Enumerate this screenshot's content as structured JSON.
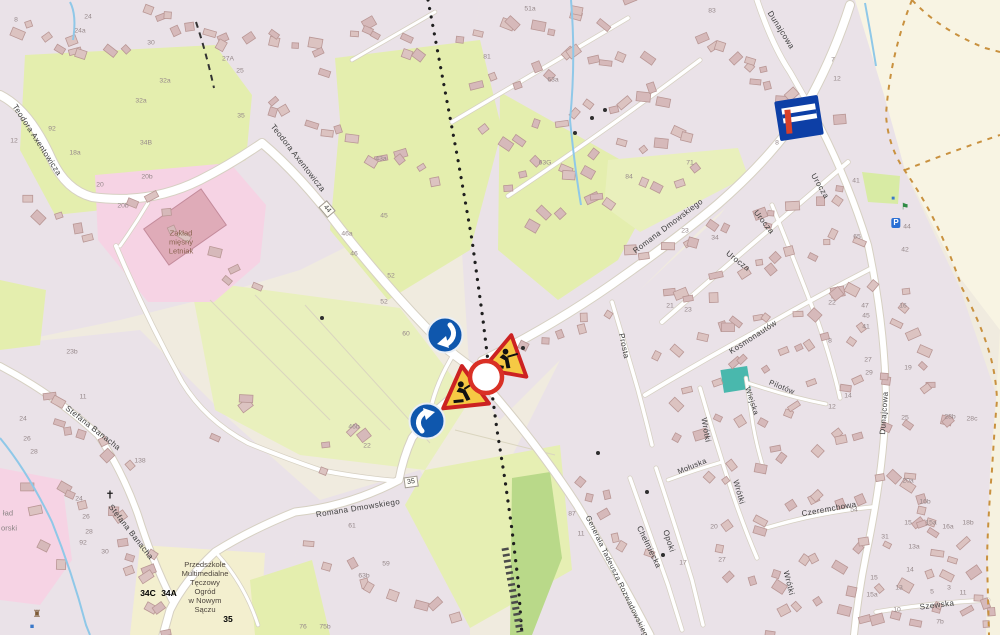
{
  "map": {
    "colors": {
      "residential": "#eae2e8",
      "field_green": "#e4eeae",
      "field_pale": "#f3efcf",
      "dark_green_band": "#b9d989",
      "commercial_pink": "#f6d3e4",
      "open_cream": "#f8f4e3",
      "road_white": "#ffffff",
      "boundary_dash_orange": "#c9913f",
      "stream_blue": "#8fc8e8",
      "sign_blue": "#0f57ad",
      "sign_red": "#d93025",
      "sign_yellow": "#f6c944",
      "flag_blue": "#0d3fa6",
      "flag_red": "#d8402a"
    },
    "streets": [
      {
        "label": "Teodora Axentowicza",
        "x": 37,
        "y": 140,
        "rot": 57
      },
      {
        "label": "Teodora Axentowicza",
        "x": 298,
        "y": 158,
        "rot": 52
      },
      {
        "label": "Romana Dmowskiego",
        "x": 668,
        "y": 226,
        "rot": -37
      },
      {
        "label": "Romana Dmowskiego",
        "x": 358,
        "y": 508,
        "rot": -9
      },
      {
        "label": "Dunajcowa",
        "x": 781,
        "y": 30,
        "rot": 58
      },
      {
        "label": "Dunajcowa",
        "x": 884,
        "y": 413,
        "rot": -86
      },
      {
        "label": "Urocza",
        "x": 820,
        "y": 186,
        "rot": 60
      },
      {
        "label": "Urocza",
        "x": 764,
        "y": 222,
        "rot": 52
      },
      {
        "label": "Urocza",
        "x": 738,
        "y": 261,
        "rot": 38
      },
      {
        "label": "Kosmonautów",
        "x": 753,
        "y": 337,
        "rot": -33
      },
      {
        "label": "Prosta",
        "x": 624,
        "y": 346,
        "rot": 78
      },
      {
        "label": "Stefana Banacha",
        "x": 93,
        "y": 428,
        "rot": 38
      },
      {
        "label": "Stefana Banacha",
        "x": 131,
        "y": 532,
        "rot": 52
      },
      {
        "label": "Generała Tadeusza Rozwadowskiego",
        "x": 618,
        "y": 578,
        "rot": 64,
        "size": 7.5
      },
      {
        "label": "Chełmiecka",
        "x": 649,
        "y": 547,
        "rot": 64
      },
      {
        "label": "Opoki",
        "x": 669,
        "y": 541,
        "rot": 72
      },
      {
        "label": "Mołuska",
        "x": 692,
        "y": 466,
        "rot": -22,
        "size": 7.5
      },
      {
        "label": "Wrótki",
        "x": 706,
        "y": 430,
        "rot": 80
      },
      {
        "label": "Wrótki",
        "x": 739,
        "y": 492,
        "rot": 74
      },
      {
        "label": "Wrótki",
        "x": 789,
        "y": 583,
        "rot": 76
      },
      {
        "label": "Wiejska",
        "x": 752,
        "y": 401,
        "rot": 72,
        "size": 7.5
      },
      {
        "label": "Pilotów",
        "x": 782,
        "y": 387,
        "rot": 22,
        "size": 7.5
      },
      {
        "label": "Czeremchowa",
        "x": 829,
        "y": 509,
        "rot": -10
      },
      {
        "label": "Szewska",
        "x": 937,
        "y": 605,
        "rot": -7
      }
    ],
    "route_badges": [
      {
        "label": "44",
        "x": 327,
        "y": 209,
        "rot": 50
      },
      {
        "label": "35",
        "x": 411,
        "y": 482,
        "rot": -8
      }
    ],
    "pois": [
      {
        "label": "Zakład\nmięsny\nLetniak",
        "x": 181,
        "y": 243,
        "color": "#8a6450"
      },
      {
        "label": "Przedszkole\nMultimedialne\nTęczowy\nOgród\nw Nowym\nSączu",
        "x": 205,
        "y": 588,
        "color": "#4e463e"
      },
      {
        "label": "ład",
        "x": 8,
        "y": 514,
        "color": "#8a8384"
      },
      {
        "label": "orski",
        "x": 9,
        "y": 529,
        "color": "#8a8384"
      }
    ],
    "annotations": [
      {
        "label": "34C",
        "x": 148,
        "y": 593
      },
      {
        "label": "34A",
        "x": 169,
        "y": 593
      },
      {
        "label": "35",
        "x": 228,
        "y": 619
      }
    ],
    "icons": [
      {
        "name": "cross-icon",
        "glyph": "✝",
        "x": 110,
        "y": 496,
        "color": "#1a1a1a",
        "size": 11
      },
      {
        "name": "parking-icon",
        "glyph": "P",
        "x": 896,
        "y": 223,
        "color": "#ffffff",
        "bg": "#2a6fd4",
        "size": 8
      },
      {
        "name": "playground-icon",
        "glyph": "⚑",
        "x": 905,
        "y": 207,
        "color": "#2e8b44",
        "size": 9
      },
      {
        "name": "info-icon",
        "glyph": "■",
        "x": 893,
        "y": 199,
        "color": "#3a78c9",
        "size": 6
      },
      {
        "name": "monument-icon",
        "glyph": "♜",
        "x": 37,
        "y": 615,
        "color": "#7d5a36",
        "size": 10
      },
      {
        "name": "water-icon",
        "glyph": "■",
        "x": 32,
        "y": 627,
        "color": "#3a78c9",
        "size": 7
      }
    ],
    "house_numbers": [
      {
        "label": "8",
        "x": 16,
        "y": 20
      },
      {
        "label": "24",
        "x": 88,
        "y": 17
      },
      {
        "label": "24a",
        "x": 80,
        "y": 31
      },
      {
        "label": "30",
        "x": 151,
        "y": 43
      },
      {
        "label": "32a",
        "x": 165,
        "y": 81
      },
      {
        "label": "32a",
        "x": 141,
        "y": 101
      },
      {
        "label": "92",
        "x": 52,
        "y": 129
      },
      {
        "label": "34B",
        "x": 146,
        "y": 143
      },
      {
        "label": "20b",
        "x": 147,
        "y": 177
      },
      {
        "label": "20b",
        "x": 123,
        "y": 206
      },
      {
        "label": "27A",
        "x": 228,
        "y": 59
      },
      {
        "label": "25",
        "x": 240,
        "y": 71
      },
      {
        "label": "12",
        "x": 14,
        "y": 141
      },
      {
        "label": "18a",
        "x": 75,
        "y": 153
      },
      {
        "label": "20",
        "x": 100,
        "y": 185
      },
      {
        "label": "35",
        "x": 241,
        "y": 116
      },
      {
        "label": "23b",
        "x": 72,
        "y": 352
      },
      {
        "label": "51a",
        "x": 530,
        "y": 9
      },
      {
        "label": "83",
        "x": 712,
        "y": 11
      },
      {
        "label": "63G",
        "x": 545,
        "y": 163
      },
      {
        "label": "43a",
        "x": 381,
        "y": 159
      },
      {
        "label": "81",
        "x": 487,
        "y": 57
      },
      {
        "label": "63a",
        "x": 553,
        "y": 80
      },
      {
        "label": "71",
        "x": 690,
        "y": 163
      },
      {
        "label": "84",
        "x": 629,
        "y": 177
      },
      {
        "label": "41",
        "x": 856,
        "y": 181
      },
      {
        "label": "65",
        "x": 857,
        "y": 237
      },
      {
        "label": "34",
        "x": 715,
        "y": 238
      },
      {
        "label": "23",
        "x": 685,
        "y": 231
      },
      {
        "label": "21",
        "x": 670,
        "y": 306
      },
      {
        "label": "23",
        "x": 688,
        "y": 310
      },
      {
        "label": "7",
        "x": 833,
        "y": 60
      },
      {
        "label": "12",
        "x": 837,
        "y": 79
      },
      {
        "label": "8",
        "x": 777,
        "y": 143
      },
      {
        "label": "46a",
        "x": 347,
        "y": 234
      },
      {
        "label": "46",
        "x": 354,
        "y": 254
      },
      {
        "label": "52",
        "x": 391,
        "y": 276
      },
      {
        "label": "52",
        "x": 384,
        "y": 302
      },
      {
        "label": "60",
        "x": 406,
        "y": 334
      },
      {
        "label": "45",
        "x": 384,
        "y": 216
      },
      {
        "label": "16",
        "x": 903,
        "y": 306
      },
      {
        "label": "19",
        "x": 908,
        "y": 368
      },
      {
        "label": "25",
        "x": 905,
        "y": 418
      },
      {
        "label": "28b",
        "x": 950,
        "y": 417
      },
      {
        "label": "28c",
        "x": 972,
        "y": 419
      },
      {
        "label": "47",
        "x": 865,
        "y": 306
      },
      {
        "label": "45",
        "x": 866,
        "y": 316
      },
      {
        "label": "41",
        "x": 866,
        "y": 327
      },
      {
        "label": "27",
        "x": 868,
        "y": 360
      },
      {
        "label": "29",
        "x": 869,
        "y": 373
      },
      {
        "label": "14",
        "x": 848,
        "y": 396
      },
      {
        "label": "12",
        "x": 832,
        "y": 407
      },
      {
        "label": "44",
        "x": 907,
        "y": 227
      },
      {
        "label": "42",
        "x": 905,
        "y": 250
      },
      {
        "label": "22",
        "x": 832,
        "y": 303
      },
      {
        "label": "8",
        "x": 830,
        "y": 341
      },
      {
        "label": "20a",
        "x": 908,
        "y": 481
      },
      {
        "label": "16b",
        "x": 925,
        "y": 502
      },
      {
        "label": "15",
        "x": 908,
        "y": 523
      },
      {
        "label": "15a",
        "x": 931,
        "y": 523
      },
      {
        "label": "16a",
        "x": 948,
        "y": 527
      },
      {
        "label": "18b",
        "x": 968,
        "y": 523
      },
      {
        "label": "13a",
        "x": 914,
        "y": 547
      },
      {
        "label": "14",
        "x": 910,
        "y": 570
      },
      {
        "label": "13",
        "x": 899,
        "y": 588
      },
      {
        "label": "5",
        "x": 932,
        "y": 592
      },
      {
        "label": "3",
        "x": 949,
        "y": 588
      },
      {
        "label": "11",
        "x": 963,
        "y": 593
      },
      {
        "label": "10",
        "x": 897,
        "y": 610
      },
      {
        "label": "15",
        "x": 874,
        "y": 578
      },
      {
        "label": "15a",
        "x": 872,
        "y": 595
      },
      {
        "label": "31",
        "x": 885,
        "y": 537
      },
      {
        "label": "54",
        "x": 854,
        "y": 510
      },
      {
        "label": "7b",
        "x": 940,
        "y": 622
      },
      {
        "label": "11",
        "x": 83,
        "y": 397
      },
      {
        "label": "24",
        "x": 23,
        "y": 419
      },
      {
        "label": "26",
        "x": 27,
        "y": 439
      },
      {
        "label": "28",
        "x": 34,
        "y": 452
      },
      {
        "label": "24",
        "x": 79,
        "y": 499
      },
      {
        "label": "26",
        "x": 86,
        "y": 517
      },
      {
        "label": "28",
        "x": 89,
        "y": 532
      },
      {
        "label": "30",
        "x": 105,
        "y": 552
      },
      {
        "label": "92",
        "x": 83,
        "y": 543
      },
      {
        "label": "138",
        "x": 140,
        "y": 461
      },
      {
        "label": "63b",
        "x": 364,
        "y": 576
      },
      {
        "label": "59",
        "x": 386,
        "y": 564
      },
      {
        "label": "61",
        "x": 352,
        "y": 526
      },
      {
        "label": "22",
        "x": 367,
        "y": 446
      },
      {
        "label": "46b",
        "x": 354,
        "y": 427
      },
      {
        "label": "76",
        "x": 303,
        "y": 627
      },
      {
        "label": "75b",
        "x": 325,
        "y": 627
      },
      {
        "label": "87",
        "x": 572,
        "y": 514
      },
      {
        "label": "11",
        "x": 581,
        "y": 534
      },
      {
        "label": "27",
        "x": 722,
        "y": 560
      },
      {
        "label": "20",
        "x": 714,
        "y": 527
      },
      {
        "label": "17",
        "x": 683,
        "y": 563
      }
    ]
  }
}
